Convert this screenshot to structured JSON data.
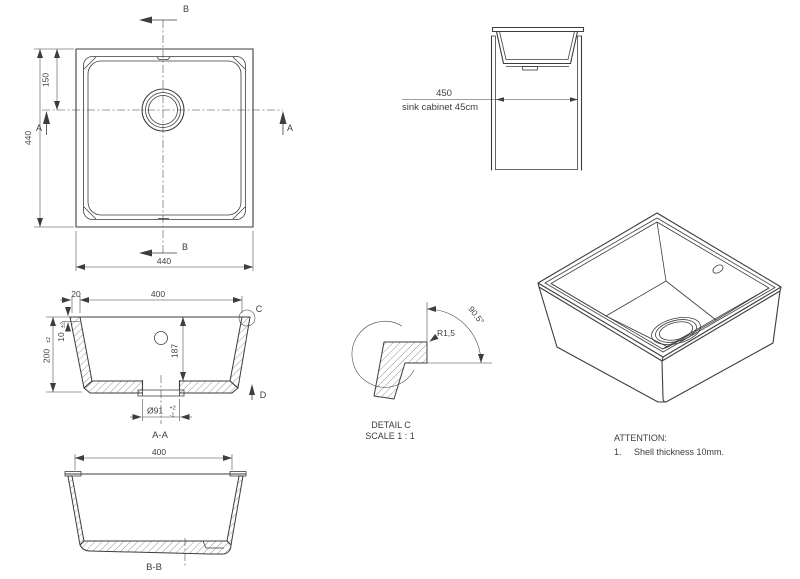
{
  "colors": {
    "line": "#3d3d3d",
    "background": "#ffffff"
  },
  "top_view": {
    "dim_left": "440",
    "dim_drain_offset": "150",
    "dim_bottom": "440",
    "marker_b_top": "B",
    "marker_b_bottom": "B",
    "marker_a_left": "A",
    "marker_a_right": "A"
  },
  "cabinet_view": {
    "dim": "450",
    "caption": "sink cabinet 45cm"
  },
  "section_aa": {
    "title": "A-A",
    "dim_width": "400",
    "dim_rim": "20",
    "dim_wall": {
      "value": "10",
      "tol": "±2"
    },
    "dim_height": {
      "value": "200",
      "tol": "±2"
    },
    "dim_depth": "187",
    "dim_drain": {
      "value": "Ø91",
      "tol_up": "+2",
      "tol_dn": "-1"
    },
    "marker_c": "C",
    "marker_d": "D"
  },
  "detail_c": {
    "title": "DETAIL C",
    "scale": "SCALE 1 : 1",
    "radius": "R1,5",
    "angle": "90.5°"
  },
  "section_bb": {
    "title": "B-B",
    "dim_width": "400"
  },
  "notes": {
    "heading": "ATTENTION:",
    "items": [
      {
        "no": "1.",
        "text": "Shell thickness 10mm."
      }
    ]
  }
}
